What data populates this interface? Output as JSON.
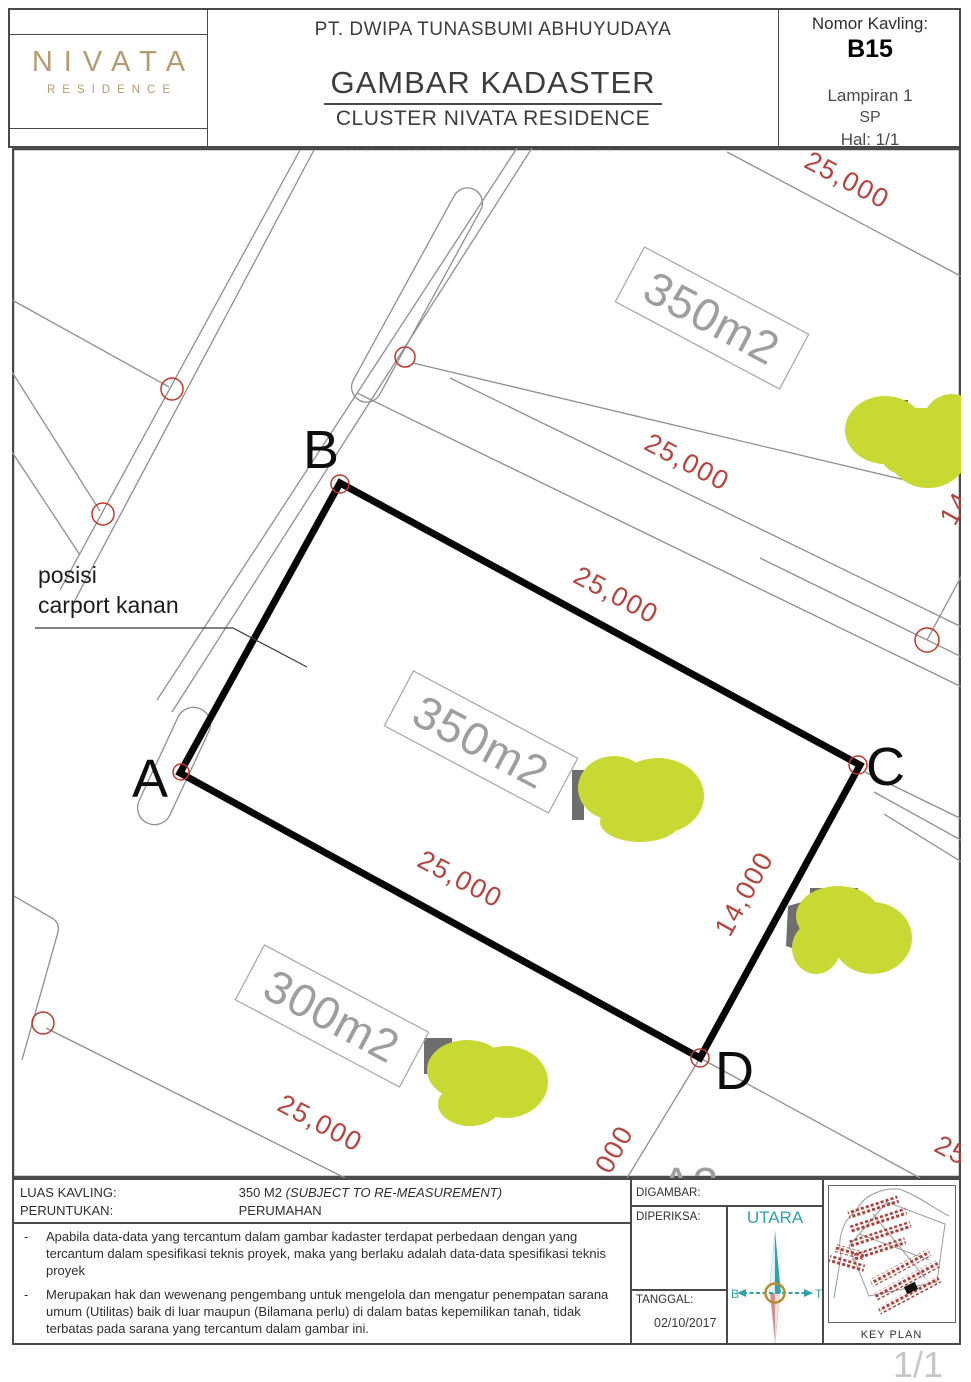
{
  "header": {
    "logo": {
      "brand": "NIVATA",
      "sub": "RESIDENCE"
    },
    "company": "PT. DWIPA TUNASBUMI ABHUYUDAYA",
    "title": "GAMBAR KADASTER",
    "subtitle": "CLUSTER NIVATA RESIDENCE",
    "location": "CIPUTRA BEACH RESORT - TANAH LOT BALI",
    "kavling_label": "Nomor Kavling:",
    "kavling_value": "B15",
    "lampiran": "Lampiran 1",
    "sp": "SP",
    "hal": "Hal: 1/1"
  },
  "drawing": {
    "corners": {
      "a": "A",
      "b": "B",
      "c": "C",
      "d": "D"
    },
    "dims": {
      "d25": "25,000",
      "d14": "14,000"
    },
    "parcels": {
      "p350": "350m2",
      "p300": "300m2",
      "pa2": "A2"
    },
    "annotation": {
      "line1": "posisi",
      "line2": "carport kanan"
    }
  },
  "footer": {
    "luas_label": "LUAS KAVLING:",
    "luas_value": "350  M2",
    "luas_note": "(SUBJECT TO RE-MEASUREMENT)",
    "peruntukan_label": "PERUNTUKAN:",
    "peruntukan_value": "PERUMAHAN",
    "bullet": "-",
    "notes": [
      "Apabila data-data yang tercantum dalam gambar kadaster terdapat perbedaan dengan yang tercantum dalam spesifikasi teknis proyek, maka yang berlaku adalah data-data spesifikasi teknis proyek",
      "Merupakan hak dan wewenang pengembang untuk mengelola dan mengatur penempatan sarana umum (Utilitas) baik di luar maupun (Bilamana perlu) di dalam batas kepemilikan tanah, tidak terbatas pada sarana yang tercantum dalam gambar ini."
    ],
    "digambar": "DIGAMBAR:",
    "diperiksa": "DIPERIKSA:",
    "tanggal_label": "TANGGAL:",
    "tanggal_value": "02/10/2017",
    "compass": {
      "north": "UTARA",
      "west": "B",
      "east": "T"
    },
    "keyplan": "KEY PLAN"
  },
  "page_number": "1/1",
  "colors": {
    "accent_red": "#b5443e",
    "highlight_green": "#c9d934",
    "brand_gold": "#b59b70",
    "compass_teal": "#2fa3ab",
    "line_gray": "#8f8f8f"
  }
}
